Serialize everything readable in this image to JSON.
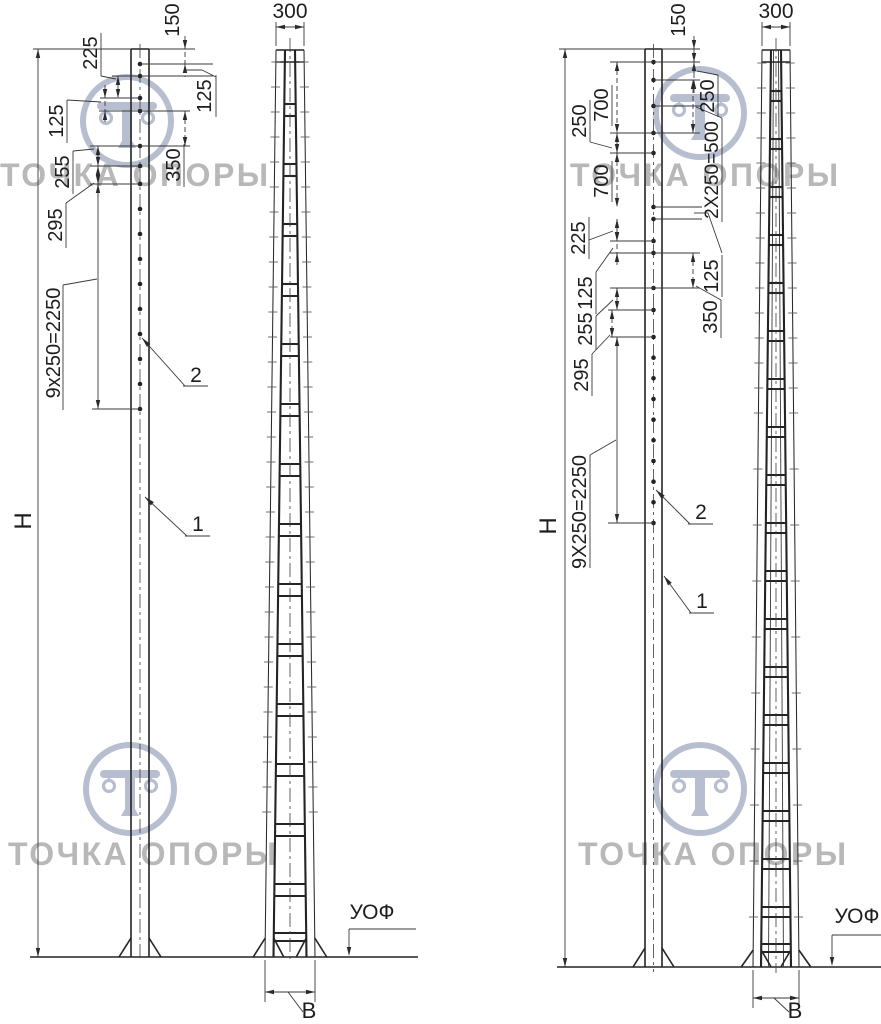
{
  "watermark": {
    "brand": "ТОЧКА ОПОРЫ"
  },
  "left": {
    "height": "H",
    "chain": "9x250=2250",
    "dim_225": "225",
    "dim_125_left": "125",
    "dim_255": "255",
    "dim_295": "295",
    "dim_150": "150",
    "dim_125_right": "125",
    "dim_350": "350",
    "callout_shaft": "1",
    "callout_holes": "2",
    "top_width": "300",
    "foundation_mark": "УОФ",
    "base_width": "В"
  },
  "right": {
    "height": "H",
    "chain": "9Х250=2250",
    "dim_700_upper": "700",
    "dim_250_left": "250",
    "dim_700_lower": "700",
    "dim_225": "225",
    "dim_125_left": "125",
    "dim_255": "255",
    "dim_295": "295",
    "dim_150": "150",
    "dim_250_right": "250",
    "dim_2x250": "2Х250=500",
    "dim_125_right": "125",
    "dim_350": "350",
    "callout_shaft": "1",
    "callout_holes": "2",
    "top_width": "300",
    "foundation_mark": "УОФ",
    "base_width": "В"
  }
}
